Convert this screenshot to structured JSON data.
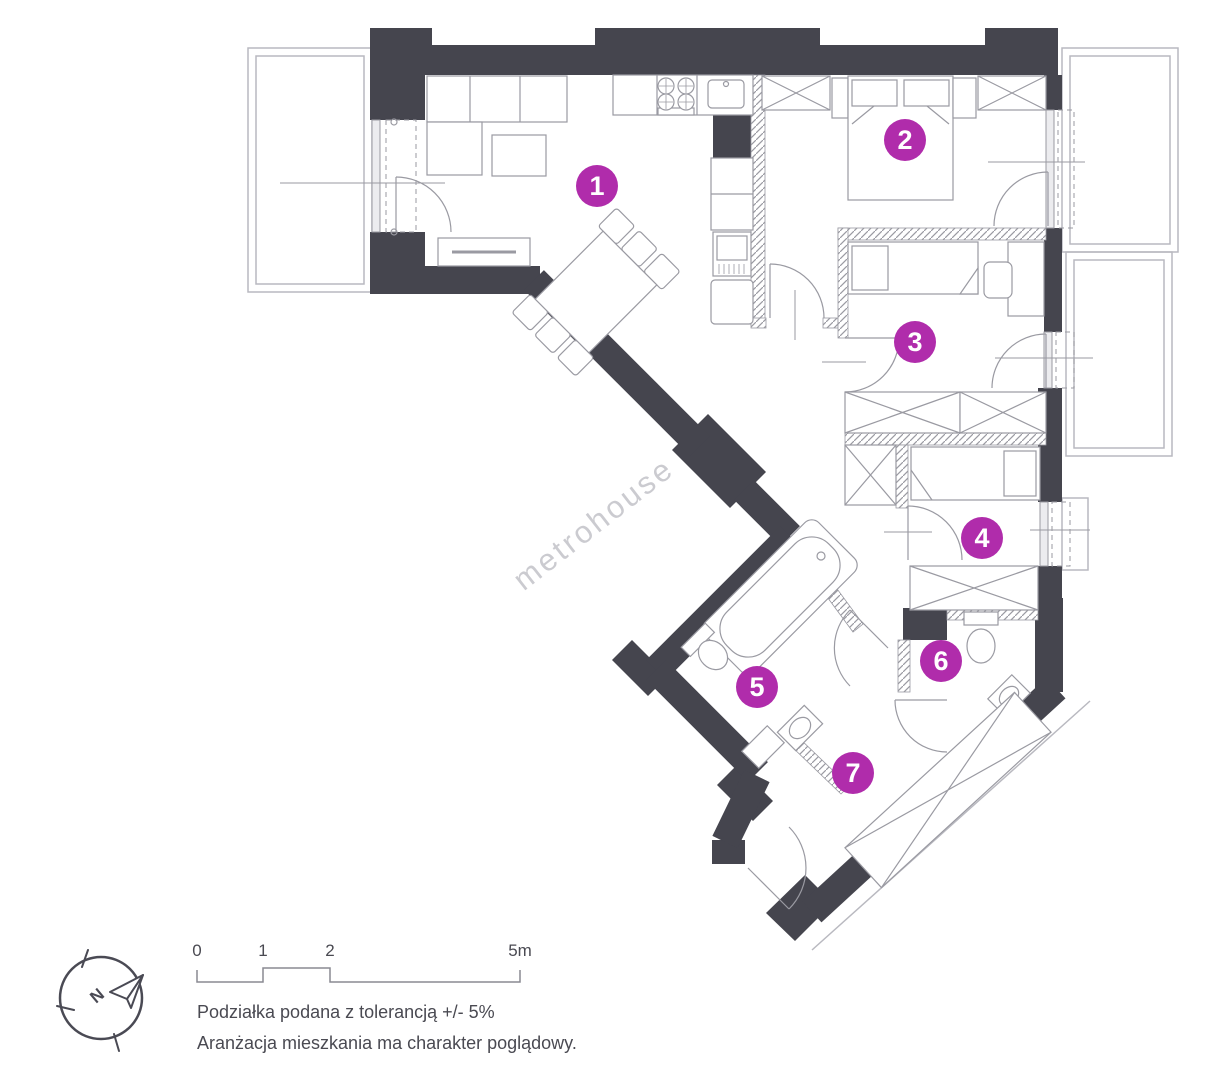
{
  "watermark": "metrohouse",
  "rooms": [
    {
      "number": "1"
    },
    {
      "number": "2"
    },
    {
      "number": "3"
    },
    {
      "number": "4"
    },
    {
      "number": "5"
    },
    {
      "number": "6"
    },
    {
      "number": "7"
    }
  ],
  "compass": {
    "letter": "N"
  },
  "scale_bar": {
    "labels": [
      "0",
      "1",
      "2",
      "5m"
    ]
  },
  "captions": {
    "line1": "Podziałka podana z tolerancją +/- 5%",
    "line2": "Aranżacja mieszkania ma charakter poglądowy."
  },
  "colors": {
    "wall": "#45454e",
    "furniture_line": "#9a9aa2",
    "light_line": "#b9b9c0",
    "badge": "#b02cab",
    "badge_text": "#ffffff",
    "watermark": "#cbcbd0",
    "text": "#4a4a52",
    "scale_line": "#8a8a92"
  }
}
